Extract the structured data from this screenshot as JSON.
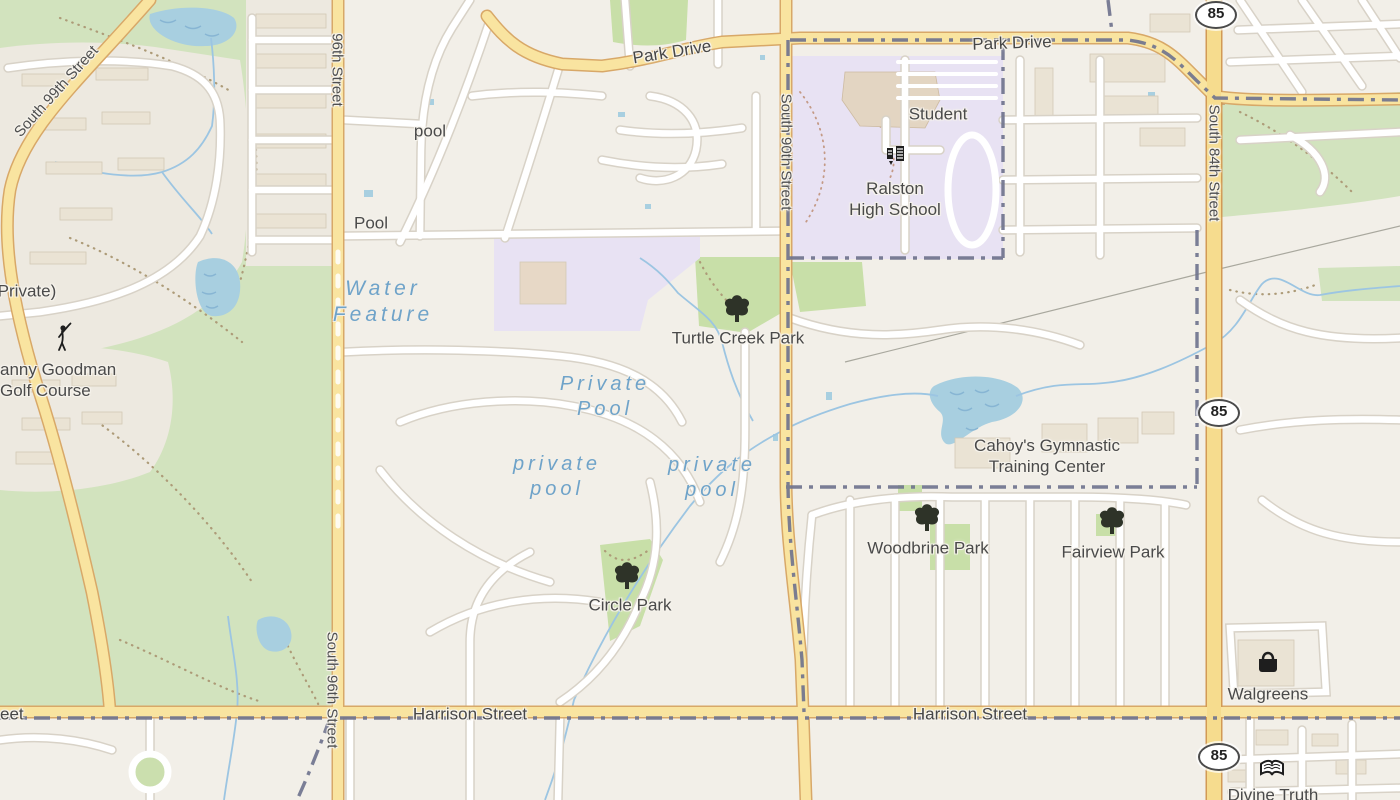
{
  "map_type": "street-map",
  "colors": {
    "land": "#F2EFE8",
    "residential": "#EDE9E0",
    "golf_green": "#D2E3BE",
    "park_green": "#C8DFA8",
    "school_purple": "#E8E2F3",
    "water": "#A8CFE0",
    "road_yellow": "#F9E4A0",
    "road_trunk_yellow": "#F6DC8E",
    "road_casing": "#D8A868",
    "road_white": "#FFFFFF",
    "boundary": "#70748E",
    "label_dark": "#4A4A4A",
    "water_label_blue": "#6FA3C9"
  },
  "shields": {
    "label": "85"
  },
  "labels": [
    {
      "text": "South 99th Street"
    },
    {
      "text": "96th Street"
    },
    {
      "text": "South 96th Street"
    },
    {
      "text": "South 90th Street"
    },
    {
      "text": "South 84th Street"
    },
    {
      "text": "Park Drive"
    },
    {
      "text": "Park Drive"
    },
    {
      "text": "Harrison Street"
    },
    {
      "text": "Harrison Street"
    },
    {
      "text": "eet"
    },
    {
      "text": "pool"
    },
    {
      "text": "Pool"
    },
    {
      "text": "Water\nFeature"
    },
    {
      "text": "Private\nPool"
    },
    {
      "text": "private\npool"
    },
    {
      "text": "private\npool"
    },
    {
      "text": "Turtle Creek Park"
    },
    {
      "text": "Student"
    },
    {
      "text": "Ralston\nHigh School"
    },
    {
      "text": "Cahoy's Gymnastic\nTraining Center"
    },
    {
      "text": "Woodbrine Park"
    },
    {
      "text": "Fairview Park"
    },
    {
      "text": "Circle Park"
    },
    {
      "text": "Walgreens"
    },
    {
      "text": "Divine Truth"
    },
    {
      "text": "(Private)"
    },
    {
      "text": "anny Goodman\nGolf Course"
    }
  ],
  "icons": [
    {
      "name": "tree-icon",
      "meaning": "park tree symbol",
      "locations": [
        "Turtle Creek Park",
        "Circle Park",
        "Woodbrine Park",
        "Fairview Park"
      ]
    },
    {
      "name": "school-icon",
      "meaning": "school building symbol",
      "locations": [
        "Ralston High School"
      ]
    },
    {
      "name": "golfer-icon",
      "meaning": "golf course symbol",
      "locations": [
        "Goodman Golf Course"
      ]
    },
    {
      "name": "shopping-bag-icon",
      "meaning": "shop symbol",
      "locations": [
        "Walgreens"
      ]
    },
    {
      "name": "book-icon",
      "meaning": "place of worship / reading symbol",
      "locations": [
        "Divine Truth"
      ]
    }
  ]
}
